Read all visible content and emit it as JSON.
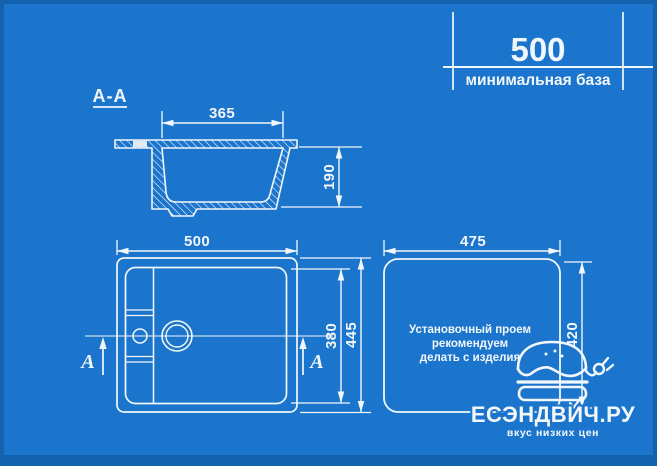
{
  "colors": {
    "background": "#1c75cd",
    "border": "#1462ae",
    "line": "#f2f7fb"
  },
  "header_dim": {
    "value": "500",
    "label": "минимальная база"
  },
  "section_view": {
    "title": "A-A",
    "width_dim": "365",
    "depth_dim": "190"
  },
  "plan_view": {
    "width_dim": "500",
    "bowl_dim": "380",
    "length_dim": "445",
    "mark_left": "A",
    "mark_right": "A"
  },
  "install_view": {
    "width_dim": "475",
    "height_dim": "420",
    "note_line1": "Установочный проем",
    "note_line2": "рекомендуем",
    "note_line3": "делать с изделия"
  },
  "logo": {
    "brand": "ЕСЭНДВИЧ.РУ",
    "tagline": "вкус низких цен",
    "icon": "burger-plug-icon"
  }
}
